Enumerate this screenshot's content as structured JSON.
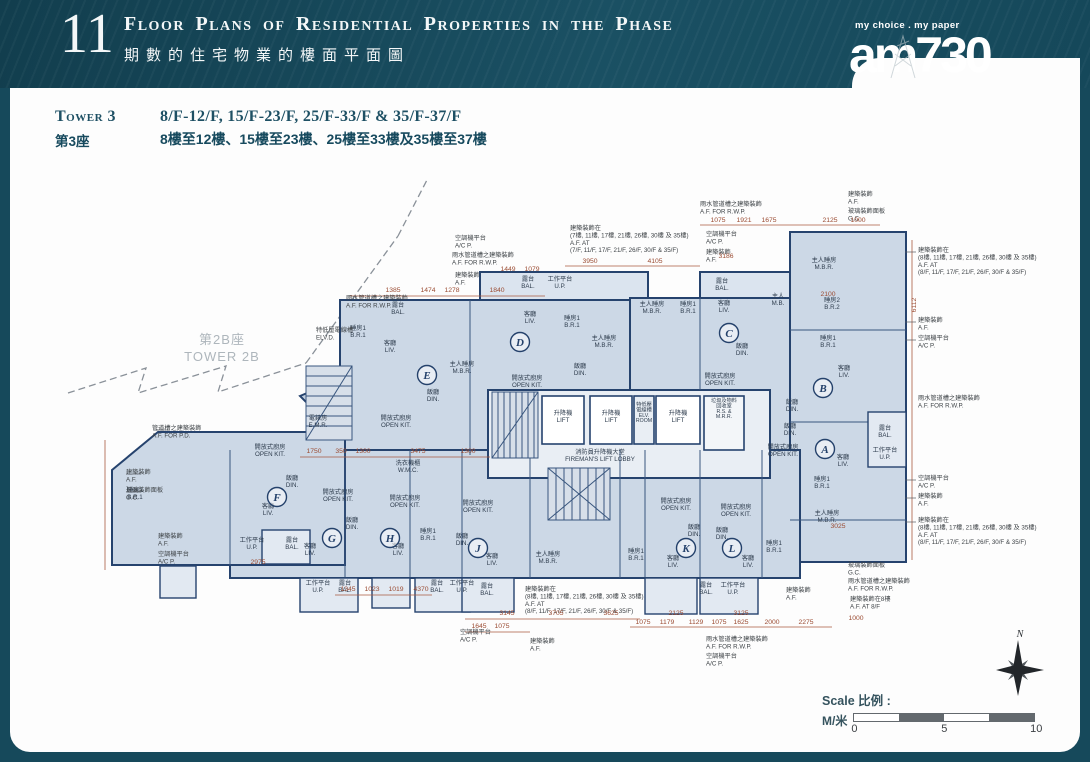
{
  "header": {
    "section_number": "11",
    "title_en": "Floor Plans of Residential Properties in the Phase",
    "title_zh": "期數的住宅物業的樓面平面圖",
    "logo_tagline": "my choice . my paper",
    "logo_name": "am730"
  },
  "tower_heading": {
    "tower_en": "Tower 3",
    "tower_zh": "第3座",
    "floors_en": "8/F-12/F, 15/F-23/F, 25/F-33/F & 35/F-37/F",
    "floors_zh": "8樓至12樓、15樓至23樓、25樓至33樓及35樓至37樓"
  },
  "plan": {
    "adjacent_tower": {
      "zh": "第2B座",
      "en": "TOWER 2B",
      "x": 222,
      "y": 344
    },
    "units": [
      {
        "letter": "A",
        "x": 825,
        "y": 449
      },
      {
        "letter": "B",
        "x": 823,
        "y": 388
      },
      {
        "letter": "C",
        "x": 729,
        "y": 333
      },
      {
        "letter": "D",
        "x": 520,
        "y": 342
      },
      {
        "letter": "E",
        "x": 427,
        "y": 375
      },
      {
        "letter": "F",
        "x": 277,
        "y": 497
      },
      {
        "letter": "G",
        "x": 332,
        "y": 538
      },
      {
        "letter": "H",
        "x": 390,
        "y": 538
      },
      {
        "letter": "J",
        "x": 478,
        "y": 548
      },
      {
        "letter": "K",
        "x": 686,
        "y": 548
      },
      {
        "letter": "L",
        "x": 732,
        "y": 548
      }
    ],
    "core_labels": [
      {
        "x": 563,
        "y": 415,
        "lines": [
          "升降機",
          "LIFT"
        ]
      },
      {
        "x": 611,
        "y": 415,
        "lines": [
          "升降機",
          "LIFT"
        ]
      },
      {
        "x": 678,
        "y": 415,
        "lines": [
          "升降機",
          "LIFT"
        ]
      },
      {
        "x": 644,
        "y": 406,
        "cls": "room-sm",
        "lines": [
          "特低壓",
          "電線槽",
          "ELV.",
          "ROOM"
        ]
      },
      {
        "x": 724,
        "y": 402,
        "cls": "room-sm",
        "lines": [
          "垃圾及物料",
          "回收室",
          "R.S. &",
          "M.R.R."
        ]
      },
      {
        "x": 600,
        "y": 454,
        "lines": [
          "消防員升降機大堂",
          "FIREMAN'S LIFT LOBBY"
        ]
      },
      {
        "x": 318,
        "y": 420,
        "lines": [
          "電錶房",
          "E.M.R."
        ]
      }
    ],
    "room_labels": [
      {
        "x": 398,
        "y": 307,
        "lines": [
          "露台",
          "BAL."
        ]
      },
      {
        "x": 358,
        "y": 330,
        "lines": [
          "睡房1",
          "B.R.1"
        ]
      },
      {
        "x": 390,
        "y": 345,
        "lines": [
          "客廳",
          "LIV."
        ]
      },
      {
        "x": 462,
        "y": 366,
        "lines": [
          "主人睡房",
          "M.B.R."
        ]
      },
      {
        "x": 433,
        "y": 394,
        "lines": [
          "飯廳",
          "DIN."
        ]
      },
      {
        "x": 396,
        "y": 420,
        "lines": [
          "開放式廚房",
          "OPEN KIT."
        ]
      },
      {
        "x": 528,
        "y": 281,
        "lines": [
          "露台",
          "BAL."
        ]
      },
      {
        "x": 560,
        "y": 281,
        "lines": [
          "工作平台",
          "U.P."
        ]
      },
      {
        "x": 530,
        "y": 316,
        "lines": [
          "客廳",
          "LIV."
        ]
      },
      {
        "x": 572,
        "y": 320,
        "lines": [
          "睡房1",
          "B.R.1"
        ]
      },
      {
        "x": 604,
        "y": 340,
        "lines": [
          "主人睡房",
          "M.B.R."
        ]
      },
      {
        "x": 580,
        "y": 368,
        "lines": [
          "飯廳",
          "DIN."
        ]
      },
      {
        "x": 527,
        "y": 380,
        "lines": [
          "開放式廚房",
          "OPEN KIT."
        ]
      },
      {
        "x": 722,
        "y": 283,
        "lines": [
          "露台",
          "BAL."
        ]
      },
      {
        "x": 652,
        "y": 306,
        "lines": [
          "主人睡房",
          "M.B.R."
        ]
      },
      {
        "x": 688,
        "y": 306,
        "lines": [
          "睡房1",
          "B.R.1"
        ]
      },
      {
        "x": 724,
        "y": 305,
        "lines": [
          "客廳",
          "LIV."
        ]
      },
      {
        "x": 742,
        "y": 348,
        "lines": [
          "飯廳",
          "DIN."
        ]
      },
      {
        "x": 720,
        "y": 378,
        "lines": [
          "開放式廚房",
          "OPEN KIT."
        ]
      },
      {
        "x": 778,
        "y": 298,
        "lines": [
          "主人",
          "M.B."
        ]
      },
      {
        "x": 824,
        "y": 262,
        "lines": [
          "主人睡房",
          "M.B.R."
        ]
      },
      {
        "x": 832,
        "y": 302,
        "lines": [
          "睡房2",
          "B.R.2"
        ]
      },
      {
        "x": 828,
        "y": 340,
        "lines": [
          "睡房1",
          "B.R.1"
        ]
      },
      {
        "x": 844,
        "y": 370,
        "lines": [
          "客廳",
          "LIV."
        ]
      },
      {
        "x": 792,
        "y": 404,
        "lines": [
          "飯廳",
          "DIN."
        ]
      },
      {
        "x": 790,
        "y": 428,
        "lines": [
          "飯廳",
          "DIN."
        ]
      },
      {
        "x": 783,
        "y": 449,
        "lines": [
          "開放式廚房",
          "OPEN KIT."
        ]
      },
      {
        "x": 843,
        "y": 459,
        "lines": [
          "客廳",
          "LIV."
        ]
      },
      {
        "x": 885,
        "y": 430,
        "lines": [
          "露台",
          "BAL."
        ]
      },
      {
        "x": 885,
        "y": 452,
        "lines": [
          "工作平台",
          "U.P."
        ]
      },
      {
        "x": 822,
        "y": 481,
        "lines": [
          "睡房1",
          "B.R.1"
        ]
      },
      {
        "x": 827,
        "y": 515,
        "lines": [
          "主人睡房",
          "M.B.R."
        ]
      },
      {
        "x": 135,
        "y": 492,
        "lines": [
          "睡房1",
          "B.R.1"
        ]
      },
      {
        "x": 270,
        "y": 449,
        "lines": [
          "開放式廚房",
          "OPEN KIT."
        ]
      },
      {
        "x": 292,
        "y": 480,
        "lines": [
          "飯廳",
          "DIN."
        ]
      },
      {
        "x": 268,
        "y": 508,
        "lines": [
          "客廳",
          "LIV."
        ]
      },
      {
        "x": 252,
        "y": 542,
        "lines": [
          "工作平台",
          "U.P."
        ]
      },
      {
        "x": 292,
        "y": 542,
        "lines": [
          "露台",
          "BAL."
        ]
      },
      {
        "x": 338,
        "y": 494,
        "lines": [
          "開放式廚房",
          "OPEN KIT."
        ]
      },
      {
        "x": 352,
        "y": 522,
        "lines": [
          "飯廳",
          "DIN."
        ]
      },
      {
        "x": 310,
        "y": 548,
        "lines": [
          "客廳",
          "LIV."
        ]
      },
      {
        "x": 318,
        "y": 585,
        "lines": [
          "工作平台",
          "U.P."
        ]
      },
      {
        "x": 345,
        "y": 585,
        "lines": [
          "露台",
          "BAL."
        ]
      },
      {
        "x": 408,
        "y": 465,
        "lines": [
          "洗衣機櫃",
          "W.M.C."
        ]
      },
      {
        "x": 405,
        "y": 500,
        "lines": [
          "開放式廚房",
          "OPEN KIT."
        ]
      },
      {
        "x": 428,
        "y": 533,
        "lines": [
          "睡房1",
          "B.R.1"
        ]
      },
      {
        "x": 398,
        "y": 548,
        "lines": [
          "客廳",
          "LIV."
        ]
      },
      {
        "x": 437,
        "y": 585,
        "lines": [
          "露台",
          "BAL."
        ]
      },
      {
        "x": 462,
        "y": 585,
        "lines": [
          "工作平台",
          "U.P."
        ]
      },
      {
        "x": 478,
        "y": 505,
        "lines": [
          "開放式廚房",
          "OPEN KIT."
        ]
      },
      {
        "x": 462,
        "y": 538,
        "lines": [
          "飯廳",
          "DIN."
        ]
      },
      {
        "x": 492,
        "y": 558,
        "lines": [
          "客廳",
          "LIV."
        ]
      },
      {
        "x": 548,
        "y": 556,
        "lines": [
          "主人睡房",
          "M.B.R."
        ]
      },
      {
        "x": 487,
        "y": 588,
        "lines": [
          "露台",
          "BAL."
        ]
      },
      {
        "x": 676,
        "y": 503,
        "lines": [
          "開放式廚房",
          "OPEN KIT."
        ]
      },
      {
        "x": 694,
        "y": 529,
        "lines": [
          "飯廳",
          "DIN."
        ]
      },
      {
        "x": 636,
        "y": 553,
        "lines": [
          "睡房1",
          "B.R.1"
        ]
      },
      {
        "x": 673,
        "y": 560,
        "lines": [
          "客廳",
          "LIV."
        ]
      },
      {
        "x": 736,
        "y": 509,
        "lines": [
          "開放式廚房",
          "OPEN KIT."
        ]
      },
      {
        "x": 722,
        "y": 532,
        "lines": [
          "飯廳",
          "DIN."
        ]
      },
      {
        "x": 748,
        "y": 560,
        "lines": [
          "客廳",
          "LIV."
        ]
      },
      {
        "x": 774,
        "y": 545,
        "lines": [
          "睡房1",
          "B.R.1"
        ]
      },
      {
        "x": 706,
        "y": 587,
        "lines": [
          "露台",
          "BAL."
        ]
      },
      {
        "x": 733,
        "y": 587,
        "lines": [
          "工作平台",
          "U.P."
        ]
      }
    ],
    "annotations": [
      {
        "x": 455,
        "y": 240,
        "lines": [
          "空調機平台",
          "A/C P."
        ]
      },
      {
        "x": 452,
        "y": 257,
        "lines": [
          "雨水管道槽之建築裝飾",
          "A.F. FOR R.W.P."
        ]
      },
      {
        "x": 455,
        "y": 277,
        "lines": [
          "建築裝飾",
          "A.F."
        ]
      },
      {
        "x": 700,
        "y": 206,
        "lines": [
          "雨水管道槽之建築裝飾",
          "A.F. FOR R.W.P."
        ]
      },
      {
        "x": 570,
        "y": 230,
        "lines": [
          "建築裝飾在",
          "(7樓, 11樓, 17樓, 21樓, 26樓, 30樓 及 35樓)",
          "A.F. AT",
          "(7/F, 11/F, 17/F, 21/F, 26/F, 30/F & 35/F)"
        ]
      },
      {
        "x": 706,
        "y": 236,
        "lines": [
          "空調機平台",
          "A/C P."
        ]
      },
      {
        "x": 706,
        "y": 254,
        "lines": [
          "建築裝飾",
          "A.F."
        ]
      },
      {
        "x": 848,
        "y": 196,
        "lines": [
          "建築裝飾",
          "A.F."
        ]
      },
      {
        "x": 848,
        "y": 213,
        "lines": [
          "玻璃裝飾面板",
          "G.C."
        ]
      },
      {
        "x": 346,
        "y": 300,
        "lines": [
          "雨水管道槽之建築裝飾",
          "A.F. FOR R.W.P."
        ]
      },
      {
        "x": 918,
        "y": 252,
        "lines": [
          "建築裝飾在",
          "(8樓, 11樓, 17樓, 21樓, 26樓, 30樓 及 35樓)",
          "A.F. AT",
          "(8/F, 11/F, 17/F, 21/F, 26/F, 30/F & 35/F)"
        ]
      },
      {
        "x": 918,
        "y": 322,
        "lines": [
          "建築裝飾",
          "A.F."
        ]
      },
      {
        "x": 918,
        "y": 340,
        "lines": [
          "空調機平台",
          "A/C P."
        ]
      },
      {
        "x": 918,
        "y": 400,
        "lines": [
          "雨水管道槽之建築裝飾",
          "A.F. FOR R.W.P."
        ]
      },
      {
        "x": 918,
        "y": 480,
        "lines": [
          "空調機平台",
          "A/C P."
        ]
      },
      {
        "x": 918,
        "y": 498,
        "lines": [
          "建築裝飾",
          "A.F."
        ]
      },
      {
        "x": 918,
        "y": 522,
        "lines": [
          "建築裝飾在",
          "(8樓, 11樓, 17樓, 21樓, 26樓, 30樓 及 35樓)",
          "A.F. AT",
          "(8/F, 11/F, 17/F, 21/F, 26/F, 30/F & 35/F)"
        ]
      },
      {
        "x": 848,
        "y": 567,
        "lines": [
          "玻璃裝飾面板",
          "G.C."
        ]
      },
      {
        "x": 848,
        "y": 583,
        "lines": [
          "雨水管道槽之建築裝飾",
          "A.F. FOR R.W.P."
        ]
      },
      {
        "x": 850,
        "y": 601,
        "lines": [
          "建築裝飾在8樓",
          "A.F. AT 8/F"
        ]
      },
      {
        "x": 152,
        "y": 430,
        "lines": [
          "管道槽之建築裝飾",
          "A.F. FOR P.D."
        ]
      },
      {
        "x": 126,
        "y": 474,
        "lines": [
          "建築裝飾",
          "A.F."
        ]
      },
      {
        "x": 126,
        "y": 492,
        "lines": [
          "玻璃裝飾面板",
          "G.C."
        ]
      },
      {
        "x": 158,
        "y": 538,
        "lines": [
          "建築裝飾",
          "A.F."
        ]
      },
      {
        "x": 158,
        "y": 556,
        "lines": [
          "空調機平台",
          "A/C P."
        ]
      },
      {
        "x": 525,
        "y": 591,
        "lines": [
          "建築裝飾在",
          "(8樓, 11樓, 17樓, 21樓, 26樓, 30樓 及 35樓)",
          "A.F. AT",
          "(8/F, 11/F, 17/F, 21/F, 26/F, 30/F & 35/F)"
        ]
      },
      {
        "x": 460,
        "y": 634,
        "lines": [
          "空調機平台",
          "A/C P."
        ]
      },
      {
        "x": 530,
        "y": 643,
        "lines": [
          "建築裝飾",
          "A.F."
        ]
      },
      {
        "x": 706,
        "y": 641,
        "lines": [
          "雨水管道槽之建築裝飾",
          "A.F. FOR R.W.P."
        ]
      },
      {
        "x": 706,
        "y": 658,
        "lines": [
          "空調機平台",
          "A/C P."
        ]
      },
      {
        "x": 786,
        "y": 592,
        "lines": [
          "建築裝飾",
          "A.F."
        ]
      },
      {
        "x": 316,
        "y": 332,
        "lines": [
          "特低壓電線槽",
          "ELV.D."
        ]
      }
    ],
    "dimensions": [
      {
        "v": "1075",
        "x": 718,
        "y": 222
      },
      {
        "v": "1921",
        "x": 744,
        "y": 222
      },
      {
        "v": "1675",
        "x": 769,
        "y": 222
      },
      {
        "v": "2125",
        "x": 830,
        "y": 222
      },
      {
        "v": "1000",
        "x": 858,
        "y": 222
      },
      {
        "v": "3186",
        "x": 726,
        "y": 258
      },
      {
        "v": "3950",
        "x": 590,
        "y": 263
      },
      {
        "v": "4105",
        "x": 655,
        "y": 263
      },
      {
        "v": "1449",
        "x": 508,
        "y": 271
      },
      {
        "v": "1079",
        "x": 532,
        "y": 271
      },
      {
        "v": "1385",
        "x": 393,
        "y": 292
      },
      {
        "v": "1474",
        "x": 428,
        "y": 292
      },
      {
        "v": "1278",
        "x": 452,
        "y": 292
      },
      {
        "v": "1840",
        "x": 497,
        "y": 292
      },
      {
        "v": "2100",
        "x": 828,
        "y": 296
      },
      {
        "v": "6112",
        "x": 916,
        "y": 305,
        "r": -90
      },
      {
        "v": "1750",
        "x": 314,
        "y": 453
      },
      {
        "v": "350",
        "x": 341,
        "y": 453
      },
      {
        "v": "1300",
        "x": 363,
        "y": 453
      },
      {
        "v": "3475",
        "x": 418,
        "y": 453
      },
      {
        "v": "1300",
        "x": 468,
        "y": 453
      },
      {
        "v": "3025",
        "x": 838,
        "y": 528
      },
      {
        "v": "2975",
        "x": 258,
        "y": 564
      },
      {
        "v": "1345",
        "x": 348,
        "y": 591
      },
      {
        "v": "1023",
        "x": 372,
        "y": 591
      },
      {
        "v": "1019",
        "x": 396,
        "y": 591
      },
      {
        "v": "4370",
        "x": 421,
        "y": 591
      },
      {
        "v": "3145",
        "x": 507,
        "y": 615
      },
      {
        "v": "3705",
        "x": 556,
        "y": 615
      },
      {
        "v": "3625",
        "x": 611,
        "y": 615
      },
      {
        "v": "2125",
        "x": 676,
        "y": 615
      },
      {
        "v": "3125",
        "x": 741,
        "y": 615
      },
      {
        "v": "1645",
        "x": 479,
        "y": 628
      },
      {
        "v": "1075",
        "x": 502,
        "y": 628
      },
      {
        "v": "1075",
        "x": 643,
        "y": 624
      },
      {
        "v": "1179",
        "x": 667,
        "y": 624
      },
      {
        "v": "1129",
        "x": 696,
        "y": 624
      },
      {
        "v": "1075",
        "x": 719,
        "y": 624
      },
      {
        "v": "1625",
        "x": 741,
        "y": 624
      },
      {
        "v": "2000",
        "x": 772,
        "y": 624
      },
      {
        "v": "2275",
        "x": 806,
        "y": 624
      },
      {
        "v": "1000",
        "x": 856,
        "y": 620
      }
    ]
  },
  "scale_bar": {
    "label": "Scale 比例 :",
    "unit": "M/米",
    "ticks": [
      "0",
      "5",
      "10"
    ]
  },
  "compass": {
    "north_label": "N"
  }
}
